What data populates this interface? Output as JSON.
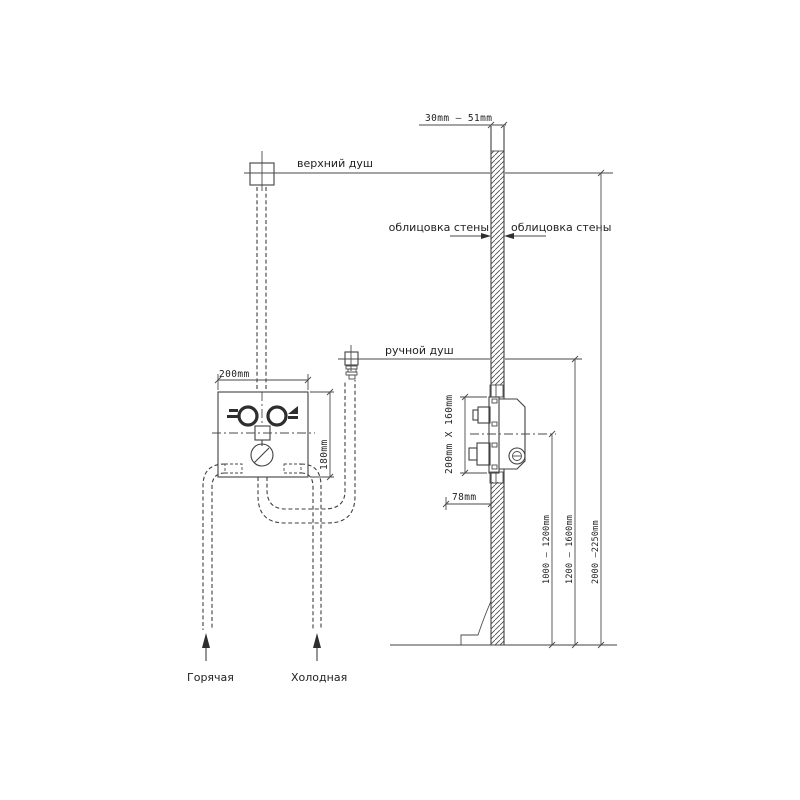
{
  "diagram": {
    "labels": {
      "wall_thickness": "30mm — 51mm",
      "upper_shower": "верхний душ",
      "wall_cladding_left": "облицовка стены",
      "wall_cladding_right": "облицовка стены",
      "hand_shower": "ручной душ",
      "box_width": "200mm",
      "box_height": "180mm",
      "side_box_dims": "200mm X 160mm",
      "box_depth": "78mm",
      "height_mixer": "1000 — 1200mm",
      "height_hand_shower": "1200 — 1600mm",
      "height_upper_shower": "2000 —2250mm",
      "hot_supply": "Горячая",
      "cold_supply": "Холодная"
    }
  }
}
